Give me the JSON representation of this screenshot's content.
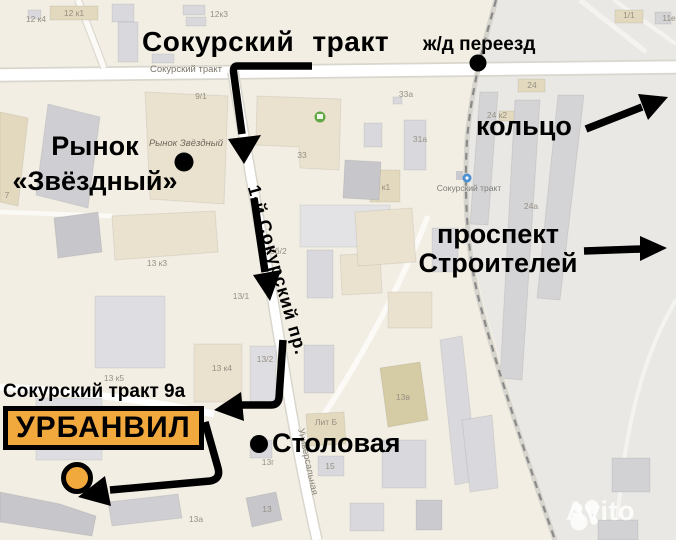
{
  "annotations": {
    "main_road_title": "Сокурский тракт",
    "railway_crossing": "ж/д переезд",
    "ring_road": "кольцо",
    "market_line1": "Рынок",
    "market_line2": "«Звёздный»",
    "prospekt_line1": "проспект",
    "prospekt_line2": "Строителей",
    "address_label": "Сокурский тракт 9а",
    "destination_name": "УРБАНВИЛ",
    "canteen_label": "Столовая",
    "side_road_label": "1-й Сокурский пр."
  },
  "map_labels": {
    "b_12k4": "12 к4",
    "b_12k1": "12 к1",
    "b_12k3": "12к3",
    "b_9_1": "9/1",
    "street_sokursky": "Сокурский тракт",
    "market_poi": "Рынок Звёздный",
    "b_33": "33",
    "b_33a": "33а",
    "b_31a": "31а",
    "b_k1": "к1",
    "b_24": "24",
    "b_24k2": "24 к2",
    "b_24a": "24а",
    "b_1_1": "1/1",
    "b_11e": "11е",
    "stop_sokursky": "Сокурский тракт",
    "b_13k3": "13 к3",
    "b_13b": "13б/2",
    "b_13_1": "13/1",
    "b_13k5": "13 к5",
    "b_13k4": "13 к4",
    "b_13_2": "13/2",
    "street_universalnaya": "Универсальная",
    "b_lit_b": "Лит Б",
    "b_13g": "13г",
    "b_15": "15",
    "b_13v": "13в",
    "b_13": "13",
    "b_13a": "13а",
    "b_7": "7"
  },
  "watermark": {
    "brand": "Avito"
  },
  "colors": {
    "highlight_yellow": "#F1A83C",
    "arrow_black": "#000000",
    "map_background": "#F2EEE3",
    "industrial_zone": "#E9E8E4",
    "watermark_white": "#FFFFFF"
  }
}
